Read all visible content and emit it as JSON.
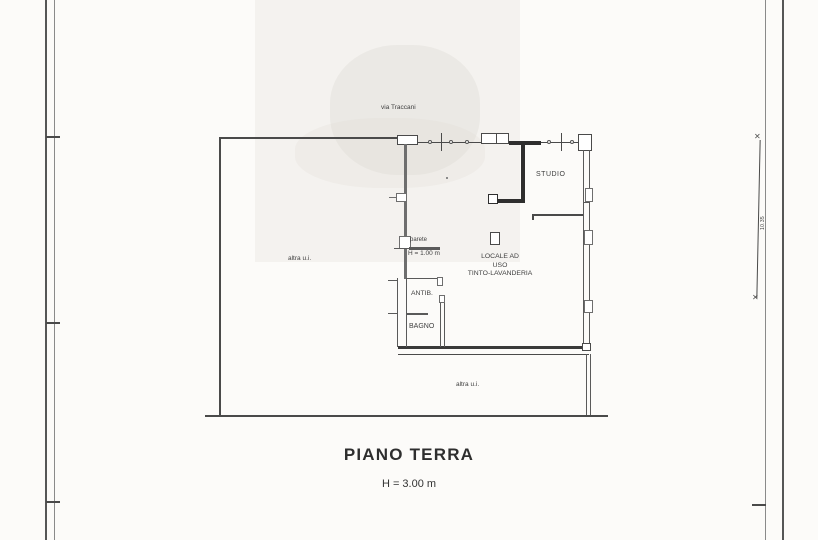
{
  "document": {
    "title": "PIANO TERRA",
    "floor_height": "H = 3.00 m",
    "street": "via Traccani"
  },
  "rooms": {
    "studio": "STUDIO",
    "locale_line1": "LOCALE AD",
    "locale_line2": "USO",
    "locale_line3": "TINTO-LAVANDERIA",
    "antibagno": "ANTIB.",
    "bagno": "BAGNO",
    "other_unit_left": "altra u.i.",
    "other_unit_bottom": "altra u.i."
  },
  "annotations": {
    "low_wall_label": "parete",
    "low_wall_height": "H = 1.00 m",
    "right_dimension": "10.35"
  },
  "colors": {
    "paper": "#fcfbf9",
    "ink": "#3a3a3a",
    "wall_dark": "#2e2e2e",
    "wall_gray": "#6e6e6e",
    "frame": "#565656"
  }
}
